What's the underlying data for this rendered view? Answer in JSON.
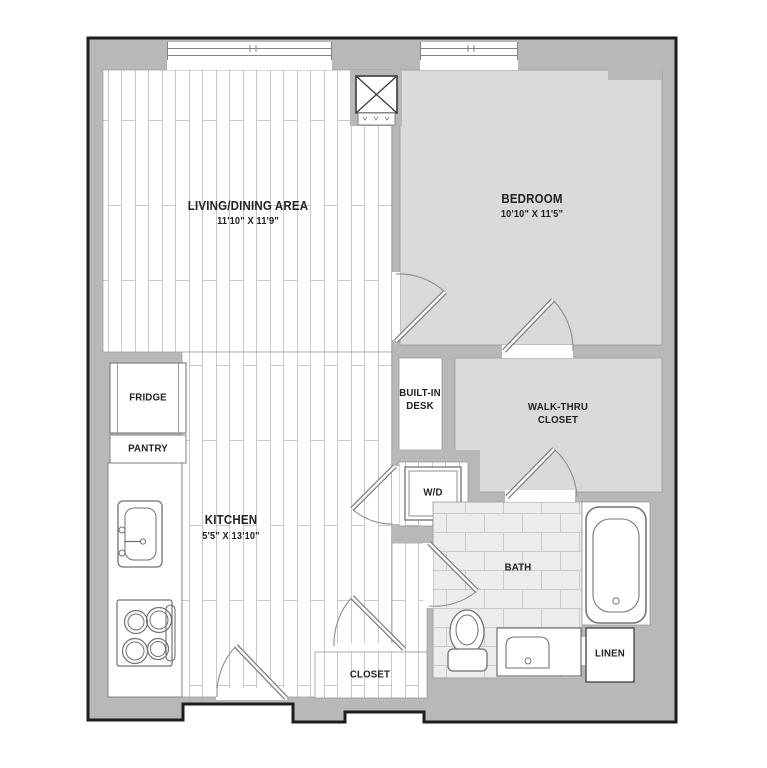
{
  "plan": {
    "rooms": {
      "living": {
        "name": "LIVING/DINING AREA",
        "dims": "11'10\" X 11'9\""
      },
      "bedroom": {
        "name": "BEDROOM",
        "dims": "10'10\" X 11'5\""
      },
      "kitchen": {
        "name": "KITCHEN",
        "dims": "5'5\" X 13'10\""
      },
      "bath": {
        "name": "BATH"
      },
      "walk_thru_closet": {
        "name": "WALK-THRU CLOSET"
      },
      "built_in_desk": {
        "name": "BUILT-IN DESK"
      },
      "wd": {
        "name": "W/D"
      },
      "closet": {
        "name": "CLOSET"
      },
      "linen": {
        "name": "LINEN"
      },
      "fridge": {
        "name": "FRIDGE"
      },
      "pantry": {
        "name": "PANTRY"
      }
    },
    "colors": {
      "wall": "#b6b8ba",
      "outline": "#1c1d1f",
      "room_floor": "#d9dadb",
      "tile_floor": "#ebeced",
      "plank_line": "#c8c9cb",
      "fixture_line": "#717376",
      "label_text": "#232021"
    }
  }
}
